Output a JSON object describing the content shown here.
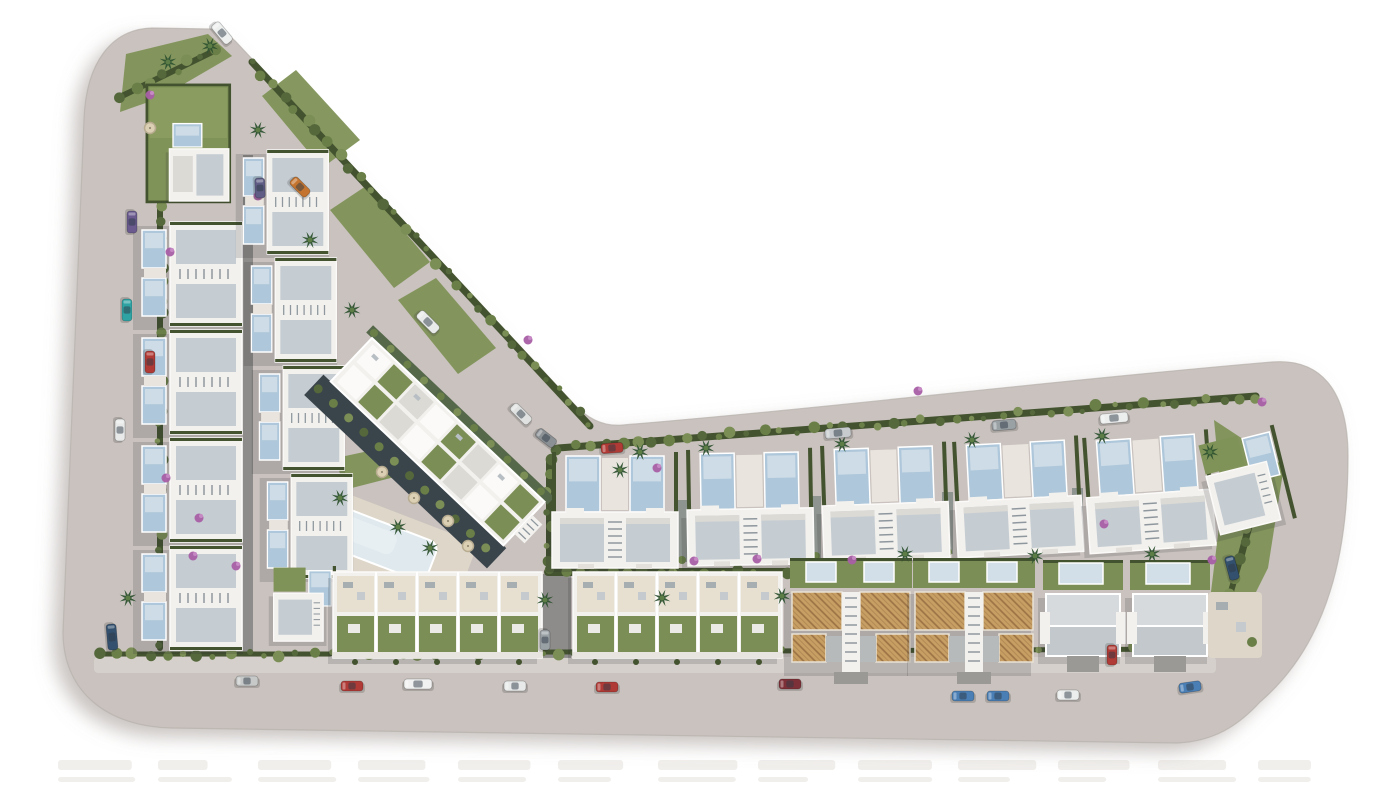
{
  "canvas": {
    "width": 1400,
    "height": 787
  },
  "palette": {
    "bg": "#ffffff",
    "land": "#c9c2be",
    "landEdgeShadow": "#9c938e",
    "curb": "#b7b0ab",
    "sidewalk": "#d5d0cb",
    "laneDark": "#5d615e",
    "laneMid": "#7f8885",
    "driveway": "#9b9995",
    "hedge": "#44532f",
    "bush1": "#55683c",
    "bush2": "#6a7f48",
    "bush3": "#7b8e55",
    "lawn": "#7f9257",
    "lawnLight": "#93a368",
    "palm": "#2e5230",
    "palmCore": "#5d7d46",
    "flower": "#a85fa5",
    "flowerLight": "#c689c4",
    "white": "#f3f1ee",
    "wall": "#fbfaf8",
    "roofPlane": "#c6cdd2",
    "roofLight": "#dcdad5",
    "roofMid": "#c2c8cb",
    "roofTop": "#d6dadc",
    "shade": "#8e979d",
    "pool": "#aec7da",
    "poolLight": "#d2dfe9",
    "poolPale": "#dfe9ee",
    "deck": "#ddd6c9",
    "terrace": "#e7e0d1",
    "paver": "#eceae6",
    "terracotta": "#c79e63",
    "terracottaLine": "#9a7244",
    "terraceGray": "#b6babb",
    "umbrella": "#dbcfb4",
    "umbrellaRing": "#b7ab90",
    "furniture": "#a7aeb2",
    "shadow": "rgba(40,40,45,0.16)",
    "darkBand": "#3a444b",
    "fringe": "#55684a",
    "watermark": "#efedea"
  },
  "land": {
    "outline_path": "M 84 120 C 86 62 112 29 152 28 L 210 29 C 223 30 231 36 239 45 L 574 404 C 587 418 603 427 623 425 C 840 407 1058 380 1272 362 C 1322 358 1348 392 1348 456 C 1348 548 1330 642 1260 702 C 1238 726 1214 741 1178 743 L 172 728 C 110 727 63 694 63 632 Z"
  },
  "sidewalks": [
    {
      "x": 94,
      "y": 657,
      "w": 1122,
      "h": 16
    }
  ],
  "lanes": [
    {
      "x": 243,
      "y": 155,
      "w": 10,
      "h": 498
    },
    {
      "x": 543,
      "y": 574,
      "w": 28,
      "h": 84
    }
  ],
  "hedges": [
    [
      160,
      172,
      160,
      648,
      6
    ],
    [
      252,
      62,
      590,
      426,
      7
    ],
    [
      558,
      448,
      1256,
      396,
      7
    ],
    [
      548,
      572,
      786,
      572,
      8
    ],
    [
      338,
      653,
      1212,
      649,
      5
    ],
    [
      1270,
      448,
      1240,
      560,
      7
    ],
    [
      1240,
      560,
      1216,
      644,
      6
    ],
    [
      100,
      654,
      330,
      654,
      5
    ],
    [
      122,
      96,
      216,
      50,
      6
    ],
    [
      549,
      460,
      549,
      562,
      6
    ]
  ],
  "lawns": [
    {
      "pts": [
        [
          126,
          54
        ],
        [
          208,
          34
        ],
        [
          232,
          56
        ],
        [
          160,
          98
        ],
        [
          120,
          112
        ]
      ]
    },
    {
      "pts": [
        [
          262,
          96
        ],
        [
          296,
          70
        ],
        [
          360,
          140
        ],
        [
          322,
          168
        ]
      ]
    },
    {
      "pts": [
        [
          330,
          210
        ],
        [
          366,
          186
        ],
        [
          430,
          262
        ],
        [
          394,
          288
        ]
      ]
    },
    {
      "pts": [
        [
          398,
          300
        ],
        [
          436,
          278
        ],
        [
          496,
          348
        ],
        [
          458,
          374
        ]
      ]
    },
    {
      "pts": [
        [
          1214,
          420
        ],
        [
          1284,
          466
        ],
        [
          1268,
          568
        ],
        [
          1232,
          640
        ],
        [
          1210,
          600
        ],
        [
          1222,
          502
        ]
      ]
    },
    {
      "pts": [
        [
          336,
          458
        ],
        [
          420,
          440
        ],
        [
          430,
          468
        ],
        [
          344,
          490
        ]
      ]
    }
  ],
  "buildings": {
    "top_villa": {
      "x": 146,
      "y": 84,
      "scale": 0.9
    },
    "arm_left_pairs": [
      {
        "x": 138,
        "y": 222
      },
      {
        "x": 138,
        "y": 330
      },
      {
        "x": 138,
        "y": 438
      },
      {
        "x": 138,
        "y": 546
      }
    ],
    "arm_right_pairs": [
      {
        "x": 240,
        "y": 150
      },
      {
        "x": 248,
        "y": 258
      },
      {
        "x": 256,
        "y": 366
      },
      {
        "x": 264,
        "y": 474
      }
    ],
    "arm_bottom_villa": {
      "x": 272,
      "y": 566,
      "scale": 0.8
    },
    "top_pairs": [
      {
        "x": 552,
        "y": 450,
        "r": 0
      },
      {
        "x": 686,
        "y": 448,
        "r": -1
      },
      {
        "x": 820,
        "y": 444,
        "r": -2
      },
      {
        "x": 952,
        "y": 440,
        "r": -3
      },
      {
        "x": 1082,
        "y": 436,
        "r": -4
      }
    ],
    "end_villa": {
      "x": 1196,
      "y": 444,
      "r": -14
    },
    "town_blocks": [
      {
        "x": 333,
        "y": 572,
        "units": 5
      },
      {
        "x": 573,
        "y": 572,
        "units": 5
      }
    ],
    "terra_pairs": [
      {
        "x": 790,
        "y": 588
      },
      {
        "x": 913,
        "y": 588
      }
    ],
    "white_semis": [
      {
        "x": 1043,
        "y": 590
      },
      {
        "x": 1130,
        "y": 590
      }
    ],
    "apartment": {
      "x": 372,
      "y": 338,
      "r": 43.5,
      "cells": 8
    },
    "patio": {
      "x": 1208,
      "y": 592,
      "w": 54,
      "h": 66
    }
  },
  "community": {
    "deck": {
      "x": 338,
      "y": 490,
      "r": 21,
      "w": 150,
      "h": 82
    },
    "pool": {
      "x": 10,
      "y": 14,
      "w": 104,
      "h": 42
    }
  },
  "vehicles": [
    {
      "x": 222,
      "y": 33,
      "r": 50,
      "c": "#eef0ef",
      "l": 24
    },
    {
      "x": 300,
      "y": 187,
      "r": 45,
      "c": "#c4742f",
      "l": 22
    },
    {
      "x": 260,
      "y": 188,
      "r": 88,
      "c": "#5f5c85",
      "l": 20
    },
    {
      "x": 428,
      "y": 322,
      "r": 45,
      "c": "#e9ebea",
      "l": 26
    },
    {
      "x": 521,
      "y": 414,
      "r": 45,
      "c": "#dfe2e1",
      "l": 24
    },
    {
      "x": 546,
      "y": 438,
      "r": 38,
      "c": "#8b9094",
      "l": 22
    },
    {
      "x": 132,
      "y": 222,
      "r": 90,
      "c": "#6a5a8e",
      "l": 22
    },
    {
      "x": 127,
      "y": 310,
      "r": 90,
      "c": "#2fa3a3",
      "l": 22
    },
    {
      "x": 150,
      "y": 362,
      "r": 90,
      "c": "#b03a35",
      "l": 22
    },
    {
      "x": 120,
      "y": 430,
      "r": 90,
      "c": "#e8eaea",
      "l": 22
    },
    {
      "x": 112,
      "y": 637,
      "r": 85,
      "c": "#33506e",
      "l": 26
    },
    {
      "x": 612,
      "y": 448,
      "r": -4,
      "c": "#b03a35",
      "l": 22
    },
    {
      "x": 838,
      "y": 433,
      "r": -5,
      "c": "#c7cbcd",
      "l": 26
    },
    {
      "x": 1004,
      "y": 425,
      "r": -5,
      "c": "#9aa1a5",
      "l": 24
    },
    {
      "x": 1114,
      "y": 418,
      "r": -5,
      "c": "#eceeee",
      "l": 28
    },
    {
      "x": 247,
      "y": 681,
      "r": 0,
      "c": "#c6c9c8",
      "l": 22
    },
    {
      "x": 352,
      "y": 686,
      "r": 0,
      "c": "#b03a35",
      "l": 22
    },
    {
      "x": 418,
      "y": 684,
      "r": 0,
      "c": "#f0f1f0",
      "l": 28
    },
    {
      "x": 515,
      "y": 686,
      "r": 0,
      "c": "#e8eaea",
      "l": 22
    },
    {
      "x": 607,
      "y": 687,
      "r": 0,
      "c": "#b03a35",
      "l": 22
    },
    {
      "x": 790,
      "y": 684,
      "r": 0,
      "c": "#7e3038",
      "l": 22
    },
    {
      "x": 963,
      "y": 696,
      "r": 0,
      "c": "#4a7fb5",
      "l": 22
    },
    {
      "x": 998,
      "y": 696,
      "r": 0,
      "c": "#4a7fb5",
      "l": 22
    },
    {
      "x": 1068,
      "y": 695,
      "r": 0,
      "c": "#eceeee",
      "l": 22
    },
    {
      "x": 1190,
      "y": 687,
      "r": -8,
      "c": "#4a7fb5",
      "l": 22
    },
    {
      "x": 1232,
      "y": 568,
      "r": 75,
      "c": "#33506e",
      "l": 24
    },
    {
      "x": 1112,
      "y": 655,
      "r": 90,
      "c": "#b03a35",
      "l": 20
    },
    {
      "x": 545,
      "y": 640,
      "r": 90,
      "c": "#9aa1a5",
      "l": 20
    }
  ],
  "vegetation": {
    "palms": [
      [
        168,
        62
      ],
      [
        210,
        46
      ],
      [
        258,
        130
      ],
      [
        310,
        240
      ],
      [
        352,
        310
      ],
      [
        340,
        498
      ],
      [
        398,
        527
      ],
      [
        430,
        548
      ],
      [
        640,
        452
      ],
      [
        706,
        448
      ],
      [
        842,
        444
      ],
      [
        972,
        440
      ],
      [
        1102,
        436
      ],
      [
        1210,
        452
      ],
      [
        545,
        600
      ],
      [
        662,
        598
      ],
      [
        782,
        596
      ],
      [
        905,
        554
      ],
      [
        1035,
        556
      ],
      [
        1152,
        554
      ],
      [
        128,
        598
      ],
      [
        620,
        470
      ]
    ],
    "flowers": [
      [
        150,
        95
      ],
      [
        170,
        252
      ],
      [
        166,
        478
      ],
      [
        199,
        518
      ],
      [
        193,
        556
      ],
      [
        236,
        566
      ],
      [
        258,
        196
      ],
      [
        528,
        340
      ],
      [
        657,
        468
      ],
      [
        694,
        561
      ],
      [
        757,
        559
      ],
      [
        918,
        391
      ],
      [
        1104,
        524
      ],
      [
        1262,
        402
      ],
      [
        1212,
        560
      ],
      [
        852,
        560
      ]
    ],
    "umbrellas": [
      [
        150,
        128
      ],
      [
        382,
        472
      ],
      [
        414,
        498
      ],
      [
        448,
        521
      ],
      [
        468,
        546
      ]
    ]
  },
  "watermark": {
    "x0": 58,
    "step": 100,
    "count": 13,
    "rows": [
      {
        "y": 760,
        "h": 10
      },
      {
        "y": 777,
        "h": 5
      }
    ]
  }
}
